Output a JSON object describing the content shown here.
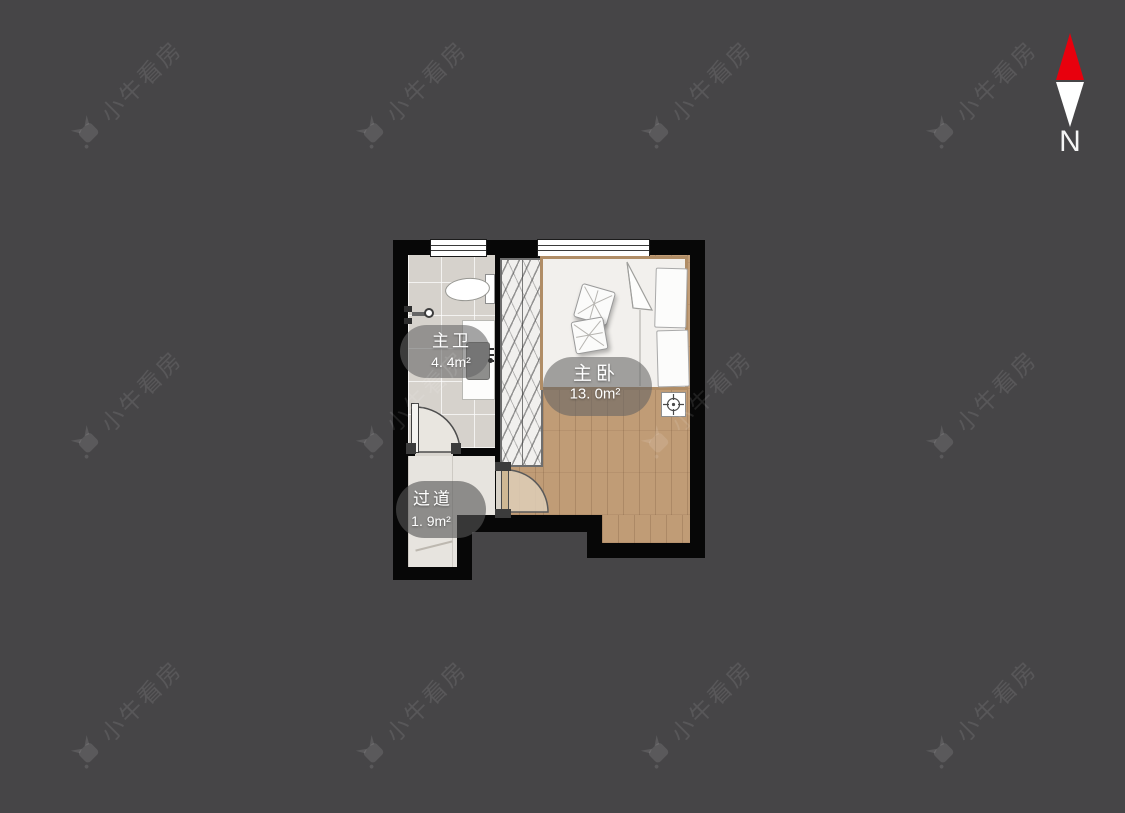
{
  "app": {
    "background_color": "#464547"
  },
  "watermark": {
    "text": "小牛看房",
    "icon": "bull-logo-icon",
    "color": "rgba(255,255,255,0.10)"
  },
  "compass": {
    "label": "N",
    "needle_north_color": "#e8000d",
    "needle_south_color": "#ffffff"
  },
  "floorplan": {
    "rooms": [
      {
        "name": "主卫",
        "area": "4. 4m²"
      },
      {
        "name": "主卧",
        "area": "13. 0m²"
      },
      {
        "name": "过道",
        "area": "1. 9m²"
      }
    ],
    "fixtures": [
      "toilet",
      "faucet",
      "sink-vanity",
      "bathroom-door",
      "wardrobe",
      "double-bed",
      "pillows",
      "folded-blanket",
      "bedroom-door",
      "floor-drain",
      "window",
      "window"
    ]
  }
}
